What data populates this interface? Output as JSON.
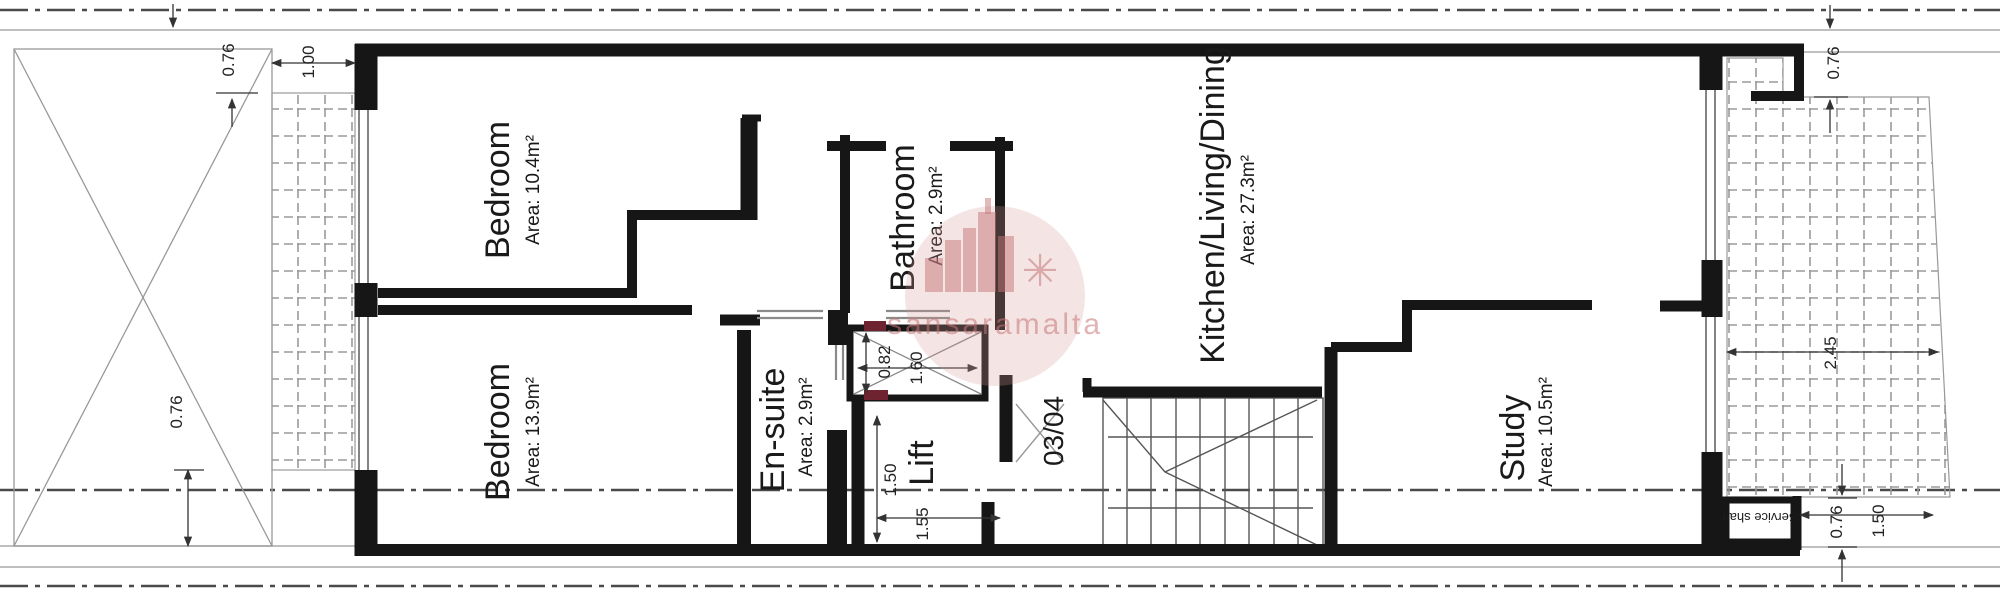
{
  "watermark": {
    "text": "sansaramalta",
    "icon_glyph": "✳"
  },
  "rooms": [
    {
      "id": "bedroom-front",
      "name": "Bedroom",
      "area": "Area: 10.4m²"
    },
    {
      "id": "bedroom-back",
      "name": "Bedroom",
      "area": "Area: 13.9m²"
    },
    {
      "id": "bathroom",
      "name": "Bathroom",
      "area": "Area: 2.9m²"
    },
    {
      "id": "ensuite",
      "name": "En-suite",
      "area": "Area: 2.9m²"
    },
    {
      "id": "kitchen-living",
      "name": "Kitchen/Living/Dining",
      "area": "Area: 27.3m²"
    },
    {
      "id": "study",
      "name": "Study",
      "area": "Area: 10.5m²"
    },
    {
      "id": "lift",
      "name": "Lift",
      "area": ""
    },
    {
      "id": "unit-number",
      "name": "03/04",
      "area": ""
    },
    {
      "id": "service-shaft",
      "name": "Service shaft",
      "area": ""
    }
  ],
  "dims": [
    {
      "id": "setback-top-left",
      "label": "0.76"
    },
    {
      "id": "balcony-width",
      "label": "1.00"
    },
    {
      "id": "setback-bottom-left",
      "label": "0.76"
    },
    {
      "id": "lift-shaft-depth",
      "label": "0.82"
    },
    {
      "id": "lift-shaft-width",
      "label": "1.60"
    },
    {
      "id": "lift-depth",
      "label": "1.50"
    },
    {
      "id": "lift-width",
      "label": "1.55"
    },
    {
      "id": "setback-top-right",
      "label": "0.76"
    },
    {
      "id": "terrace-width",
      "label": "2.45"
    },
    {
      "id": "setback-bottom-right",
      "label": "0.76"
    },
    {
      "id": "terrace-return",
      "label": "1.50"
    }
  ]
}
